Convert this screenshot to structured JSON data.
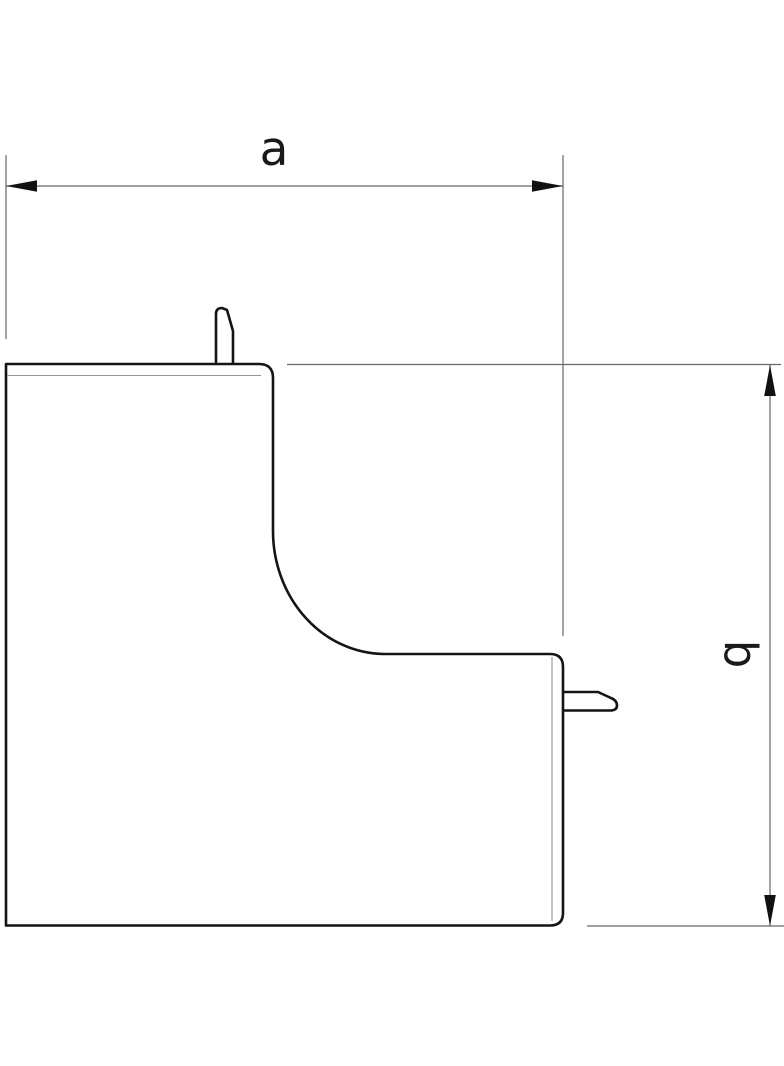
{
  "drawing": {
    "part": "internal-corner-profile",
    "dimensions": {
      "horizontal": {
        "label": "a"
      },
      "vertical": {
        "label": "b"
      }
    }
  },
  "colors": {
    "background": "#ffffff",
    "outline": "#141414",
    "dimension_lines": "#666666",
    "inner_lines": "#949494",
    "arrowheads": "#111111",
    "text": "#1a1a1a"
  }
}
